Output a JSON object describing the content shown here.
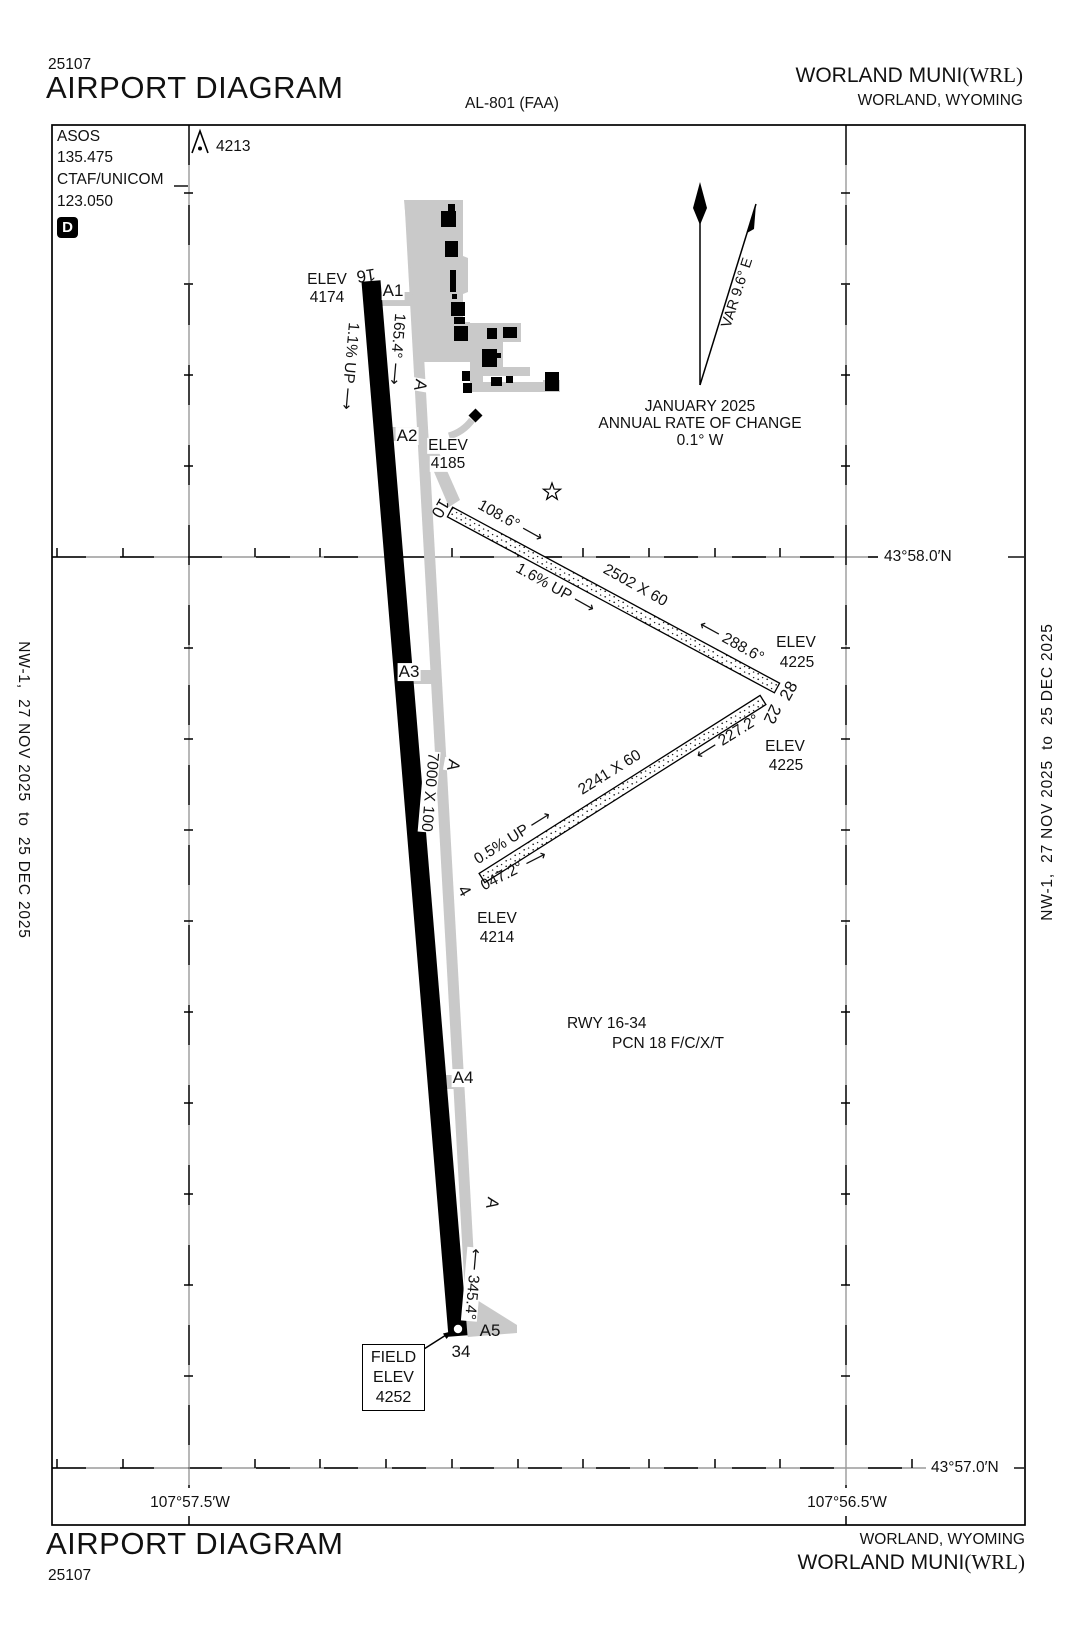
{
  "header": {
    "chart_number": "25107",
    "title": "AIRPORT DIAGRAM",
    "procedure_id": "AL-801 (FAA)",
    "airport_name": "WORLAND MUNI",
    "airport_icao": "(WRL)",
    "city": "WORLAND, WYOMING"
  },
  "footer": {
    "chart_number": "25107",
    "title": "AIRPORT DIAGRAM",
    "airport_name": "WORLAND MUNI",
    "airport_icao": "(WRL)",
    "city": "WORLAND, WYOMING"
  },
  "comm_box": {
    "asos_label": "ASOS",
    "asos_freq": "135.475",
    "ctaf_label": "CTAF/UNICOM",
    "ctaf_freq": "123.050",
    "delta_symbol": "D"
  },
  "obstacle": {
    "elevation": "4213"
  },
  "north_arrow": {
    "variation": "VAR 9.6° E",
    "date": "JANUARY 2025",
    "annual_rate_label": "ANNUAL RATE OF CHANGE",
    "annual_rate_value": "0.1° W"
  },
  "margin_notes": {
    "left": "NW-1,  27 NOV 2025  to  25 DEC 2025",
    "right": "NW-1,  27 NOV 2025  to  25 DEC 2025"
  },
  "grid": {
    "lat_top": "43°58.0′N",
    "lat_bottom": "43°57.0′N",
    "lon_left": "107°57.5′W",
    "lon_right": "107°56.5′W"
  },
  "runway_16_34": {
    "number_16": "16",
    "number_34": "34",
    "elev_16_label": "ELEV",
    "elev_16_value": "4174",
    "heading_16": "165.4° ⟶",
    "gradient": "1.1% UP ⟶",
    "dimensions": "7000 X 100",
    "heading_34": "⟵ 345.4°",
    "pcn_line1": "RWY 16-34",
    "pcn_line2": "PCN 18 F/C/X/T"
  },
  "runway_10_28": {
    "number_10": "10",
    "number_28": "28",
    "heading_10": "108.6° ⟶",
    "gradient": "1.6% UP ⟶",
    "dimensions": "2502 X 60",
    "heading_28": "⟵ 288.6°",
    "elev_10_label": "ELEV",
    "elev_10_value": "4185",
    "elev_28_label": "ELEV",
    "elev_28_value": "4225"
  },
  "runway_4_22": {
    "number_4": "4",
    "number_22": "22",
    "heading_4": "047.2° ⟶",
    "gradient": "0.5% UP ⟶",
    "dimensions": "2241 X 60",
    "heading_22": "⟵ 227.2°",
    "elev_4_label": "ELEV",
    "elev_4_value": "4214",
    "elev_22_label": "ELEV",
    "elev_22_value": "4225"
  },
  "taxiway": {
    "name": "A",
    "a1": "A1",
    "a2": "A2",
    "a3": "A3",
    "a4": "A4",
    "a5": "A5"
  },
  "field_elevation": {
    "line1": "FIELD",
    "line2": "ELEV",
    "line3": "4252"
  }
}
